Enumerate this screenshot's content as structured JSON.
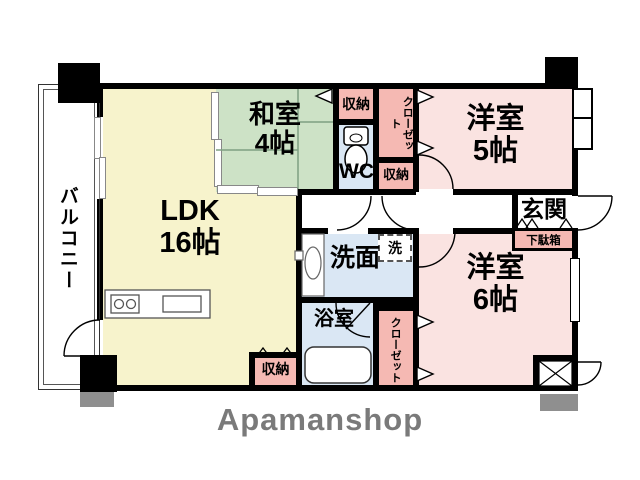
{
  "title": "apartment-floor-plan",
  "logo_text": "Apamanshop",
  "colors": {
    "wall": "#000000",
    "ldk_fill": "#F7F3CC",
    "tatami_fill": "#CDE2C6",
    "western_room_fill": "#FAE3E1",
    "closet_fill": "#F5B9B3",
    "wet_area_fill": "#DAE7F4",
    "column_shadow": "#8F8F8F",
    "logo_gray": "#7A7A7A"
  },
  "rooms": {
    "balcony": {
      "label": "バルコニー"
    },
    "ldk": {
      "label": "LDK",
      "size": "16帖"
    },
    "washitsu": {
      "label": "和室",
      "size": "4帖"
    },
    "western5": {
      "label": "洋室",
      "size": "5帖"
    },
    "western6": {
      "label": "洋室",
      "size": "6帖"
    },
    "wc": {
      "label": "WC"
    },
    "washroom": {
      "label": "洗面"
    },
    "washer": {
      "label": "洗"
    },
    "bathroom": {
      "label": "浴室"
    },
    "entrance": {
      "label": "玄関"
    },
    "shoe_cabinet": {
      "label": "下駄箱"
    },
    "storage_top": {
      "label": "収納"
    },
    "storage_mid": {
      "label": "収納"
    },
    "storage_ldk": {
      "label": "収納"
    },
    "closet_top": {
      "label": "クローゼット"
    },
    "closet_bottom": {
      "label": "クローゼット"
    }
  }
}
